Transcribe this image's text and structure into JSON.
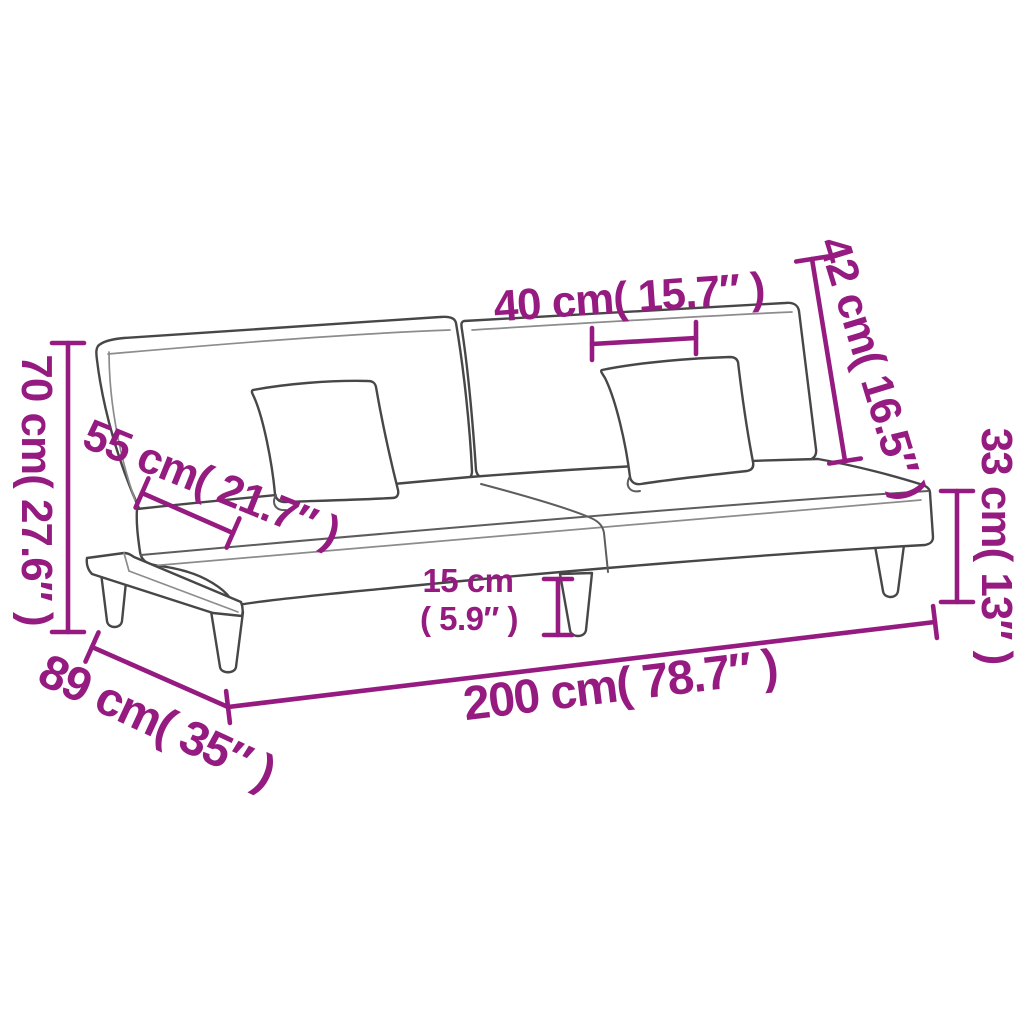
{
  "diagram": {
    "type": "product-dimension-diagram",
    "subject": "sofa-bed line drawing with measurement annotations",
    "accent_color": "#951b81",
    "line_color": "#474747",
    "background_color": "#ffffff",
    "dimensions": [
      {
        "id": "total-height",
        "cm": 70,
        "inches": 27.6,
        "label": "70 cm( 27.6″ )"
      },
      {
        "id": "seat-depth",
        "cm": 55,
        "inches": 21.7,
        "label": "55 cm( 21.7″ )"
      },
      {
        "id": "pillow-width",
        "cm": 40,
        "inches": 15.7,
        "label": "40 cm( 15.7″ )"
      },
      {
        "id": "backrest-height",
        "cm": 42,
        "inches": 16.5,
        "label": "42 cm( 16.5″ )"
      },
      {
        "id": "seat-height",
        "cm": 33,
        "inches": 13,
        "label": "33 cm( 13″ )"
      },
      {
        "id": "leg-height",
        "cm": 15,
        "inches": 5.9,
        "label_cm": "15 cm",
        "label_in": "( 5.9″ )"
      },
      {
        "id": "total-width",
        "cm": 200,
        "inches": 78.7,
        "label": "200 cm( 78.7″ )"
      },
      {
        "id": "total-depth",
        "cm": 89,
        "inches": 35,
        "label": "89 cm( 35″ )"
      }
    ]
  }
}
